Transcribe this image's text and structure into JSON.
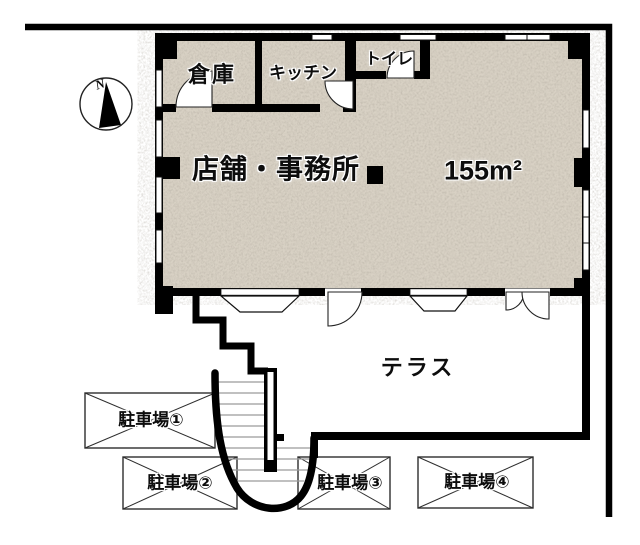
{
  "plan": {
    "compass_north": "N",
    "rooms": {
      "storage": "倉庫",
      "kitchen": "キッチン",
      "toilet": "トイレ",
      "main_label": "店舗・事務所",
      "main_area": "155m²",
      "terrace": "テラス"
    },
    "parking": [
      {
        "label": "駐車場①"
      },
      {
        "label": "駐車場②"
      },
      {
        "label": "駐車場③"
      },
      {
        "label": "駐車場④"
      }
    ],
    "colors": {
      "wall": "#000000",
      "floor": "#d8d1c4",
      "background": "#ffffff",
      "thin_line": "#333333"
    }
  }
}
